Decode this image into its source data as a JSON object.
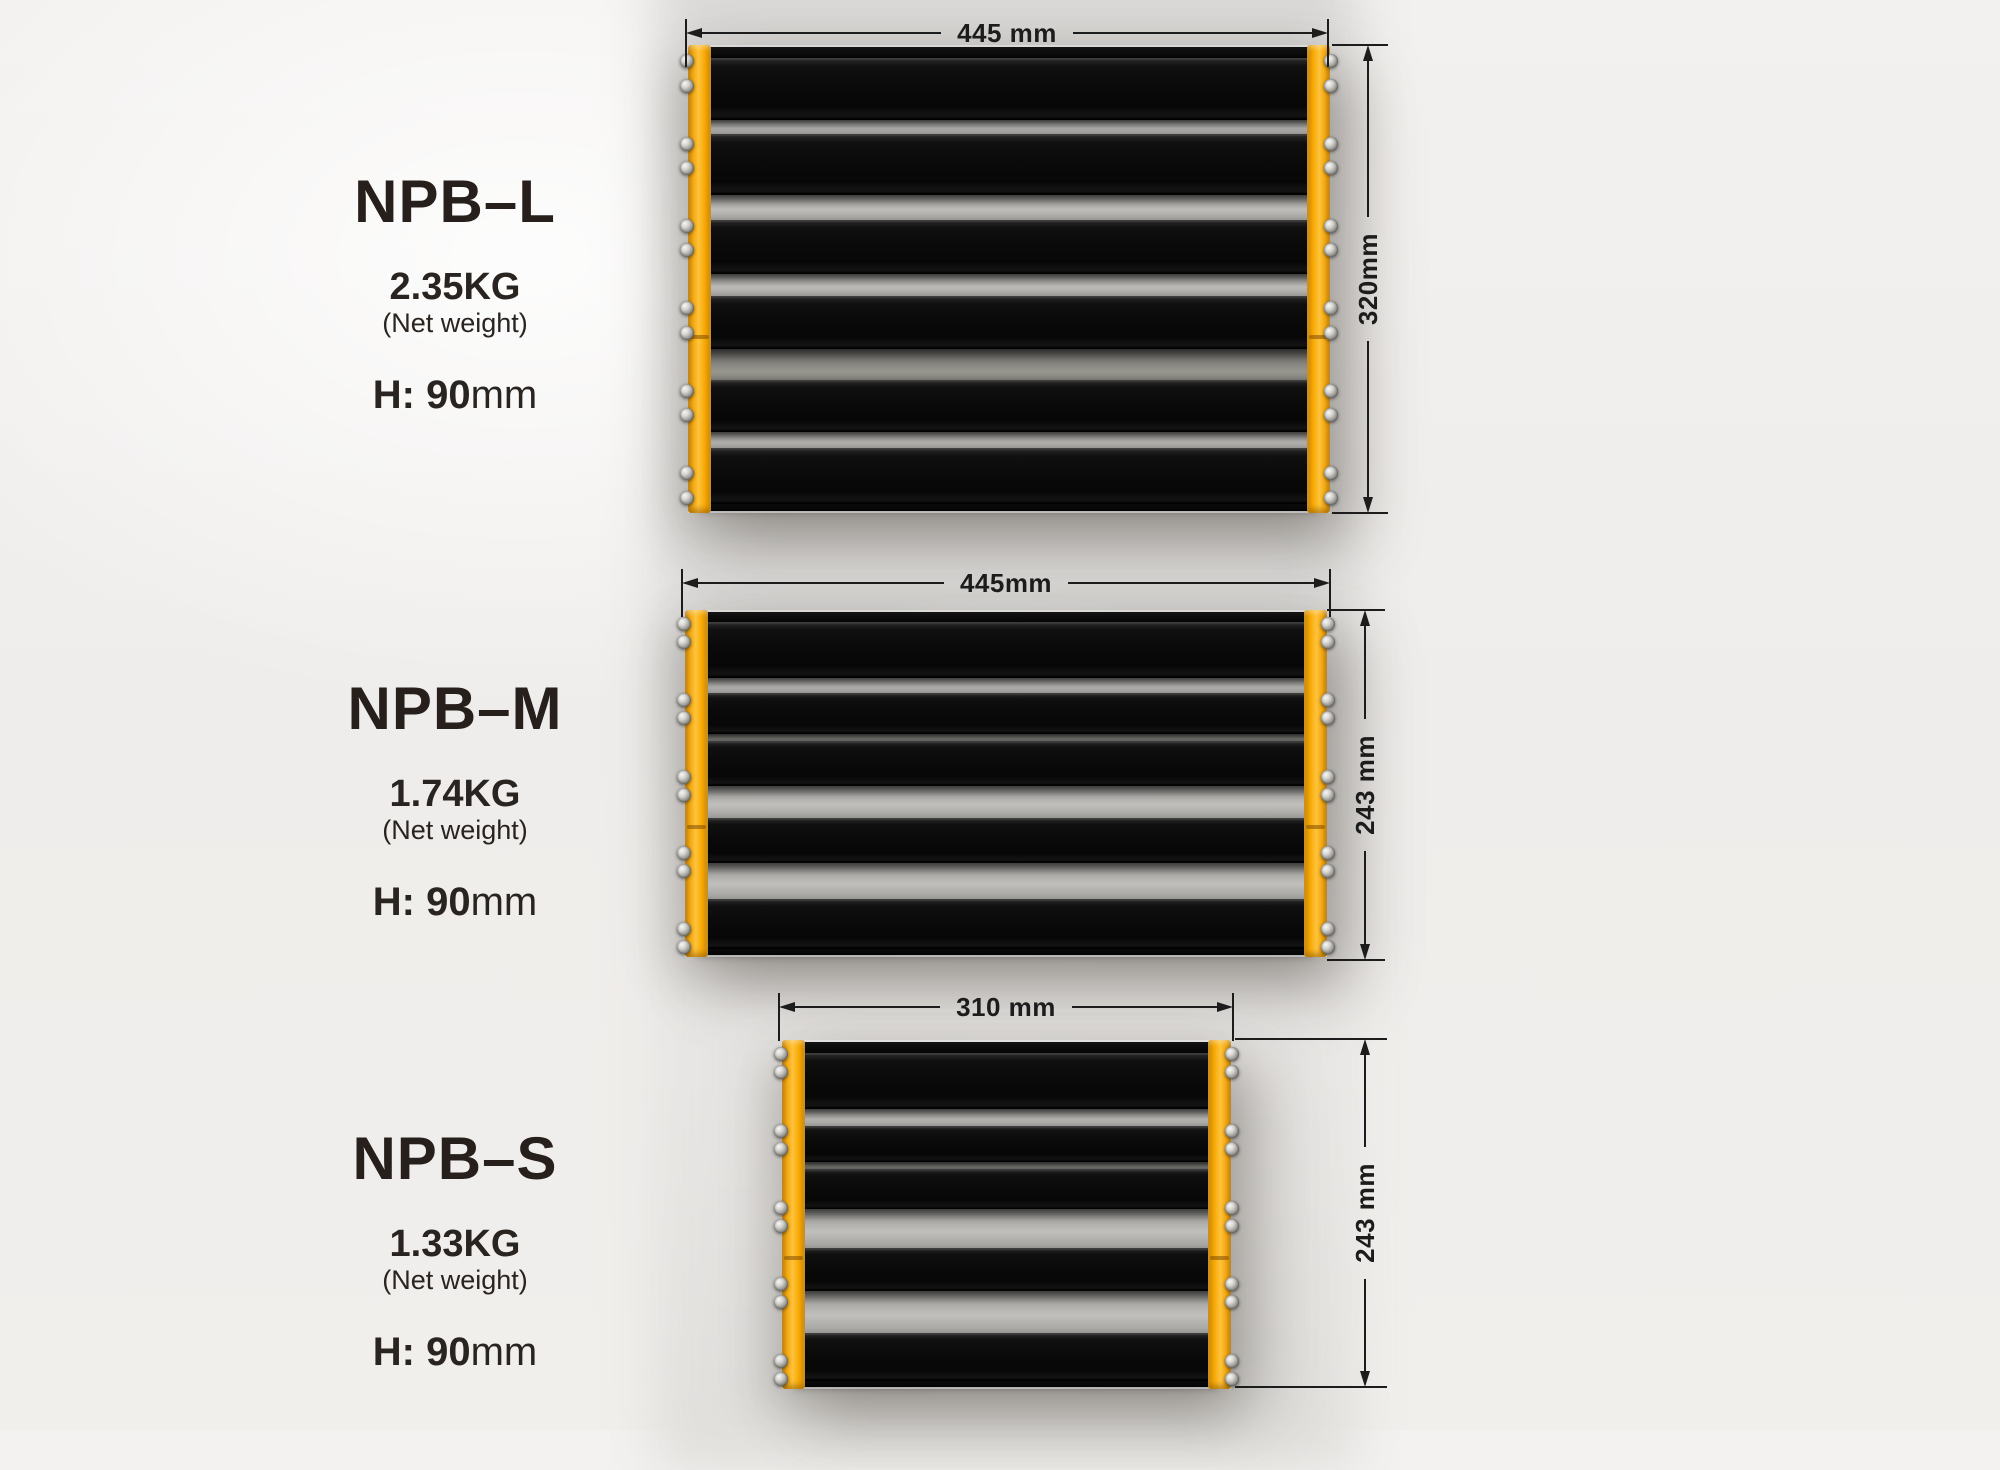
{
  "page": {
    "background": "#EFEDEA"
  },
  "colors": {
    "rail_yellow": "#F7A802",
    "slat_black": "#0A0A0A",
    "gap_gray": "#AEADAA",
    "dim_ink": "#1C1C1C",
    "text_ink": "#2A2421"
  },
  "products": [
    {
      "id": "NPB-L",
      "name": "NPB–L",
      "weight": "2.35KG",
      "weight_note": "(Net weight)",
      "height_prefix": "H: 90",
      "height_unit": "mm",
      "width_dim": "445 mm",
      "depth_dim": "320mm",
      "slat_count": 6,
      "screws_per_rail": 12
    },
    {
      "id": "NPB-M",
      "name": "NPB–M",
      "weight": "1.74KG",
      "weight_note": "(Net weight)",
      "height_prefix": "H: 90",
      "height_unit": "mm",
      "width_dim": "445mm",
      "depth_dim": "243 mm",
      "slat_count": 5,
      "screws_per_rail": 10
    },
    {
      "id": "NPB-S",
      "name": "NPB–S",
      "weight": "1.33KG",
      "weight_note": "(Net weight)",
      "height_prefix": "H: 90",
      "height_unit": "mm",
      "width_dim": "310 mm",
      "depth_dim": "243 mm",
      "slat_count": 5,
      "screws_per_rail": 10
    }
  ]
}
